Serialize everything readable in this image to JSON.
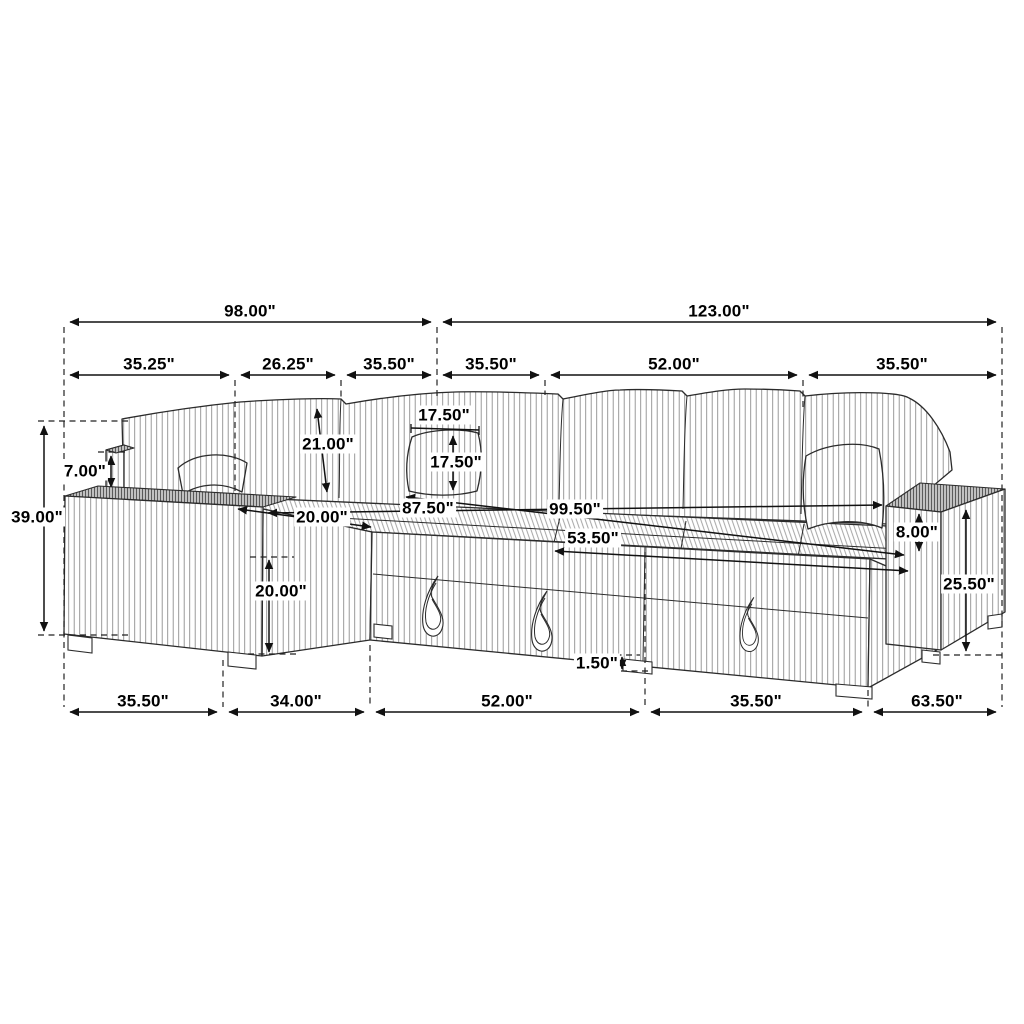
{
  "diagram": {
    "subject": "Sectional sleeper sofa dimension drawing",
    "unit": "inches",
    "line_color": "#1a1a1a",
    "label_background": "#ffffff",
    "dimensions": {
      "top_row": [
        {
          "id": "left-section-overall-width",
          "label": "98.00\""
        },
        {
          "id": "right-section-overall-width",
          "label": "123.00\""
        }
      ],
      "upper_segments": [
        {
          "id": "left-armrest-width",
          "label": "35.25\""
        },
        {
          "id": "corner-back-width",
          "label": "26.25\""
        },
        {
          "id": "left-back-cushion-width",
          "label": "35.50\""
        },
        {
          "id": "mid-back-cushion-width",
          "label": "35.50\""
        },
        {
          "id": "center-back-cushion-width",
          "label": "52.00\""
        },
        {
          "id": "right-back-cushion-width",
          "label": "35.50\""
        }
      ],
      "left_side": [
        {
          "id": "overall-height",
          "label": "39.00\""
        },
        {
          "id": "back-above-armrest",
          "label": "7.00\""
        }
      ],
      "middle": [
        {
          "id": "backrest-height",
          "label": "21.00\""
        },
        {
          "id": "pillow-width",
          "label": "17.50\""
        },
        {
          "id": "pillow-height",
          "label": "17.50\""
        },
        {
          "id": "seat-depth",
          "label": "20.00\""
        },
        {
          "id": "seat-length-back",
          "label": "87.50\""
        },
        {
          "id": "seat-length-front",
          "label": "99.50\""
        },
        {
          "id": "bed-front-length",
          "label": "53.50\""
        },
        {
          "id": "seat-front-height",
          "label": "20.00\""
        }
      ],
      "right_side": [
        {
          "id": "armrest-above-seat",
          "label": "8.00\""
        },
        {
          "id": "right-armrest-height",
          "label": "25.50\""
        },
        {
          "id": "leg-height",
          "label": "1.50\""
        }
      ],
      "bottom_row": [
        {
          "id": "left-armrest-base",
          "label": "35.50\""
        },
        {
          "id": "chaise-base",
          "label": "34.00\""
        },
        {
          "id": "bed-base",
          "label": "52.00\""
        },
        {
          "id": "right-seat-base",
          "label": "35.50\""
        },
        {
          "id": "right-armrest-base",
          "label": "63.50\""
        }
      ]
    }
  }
}
